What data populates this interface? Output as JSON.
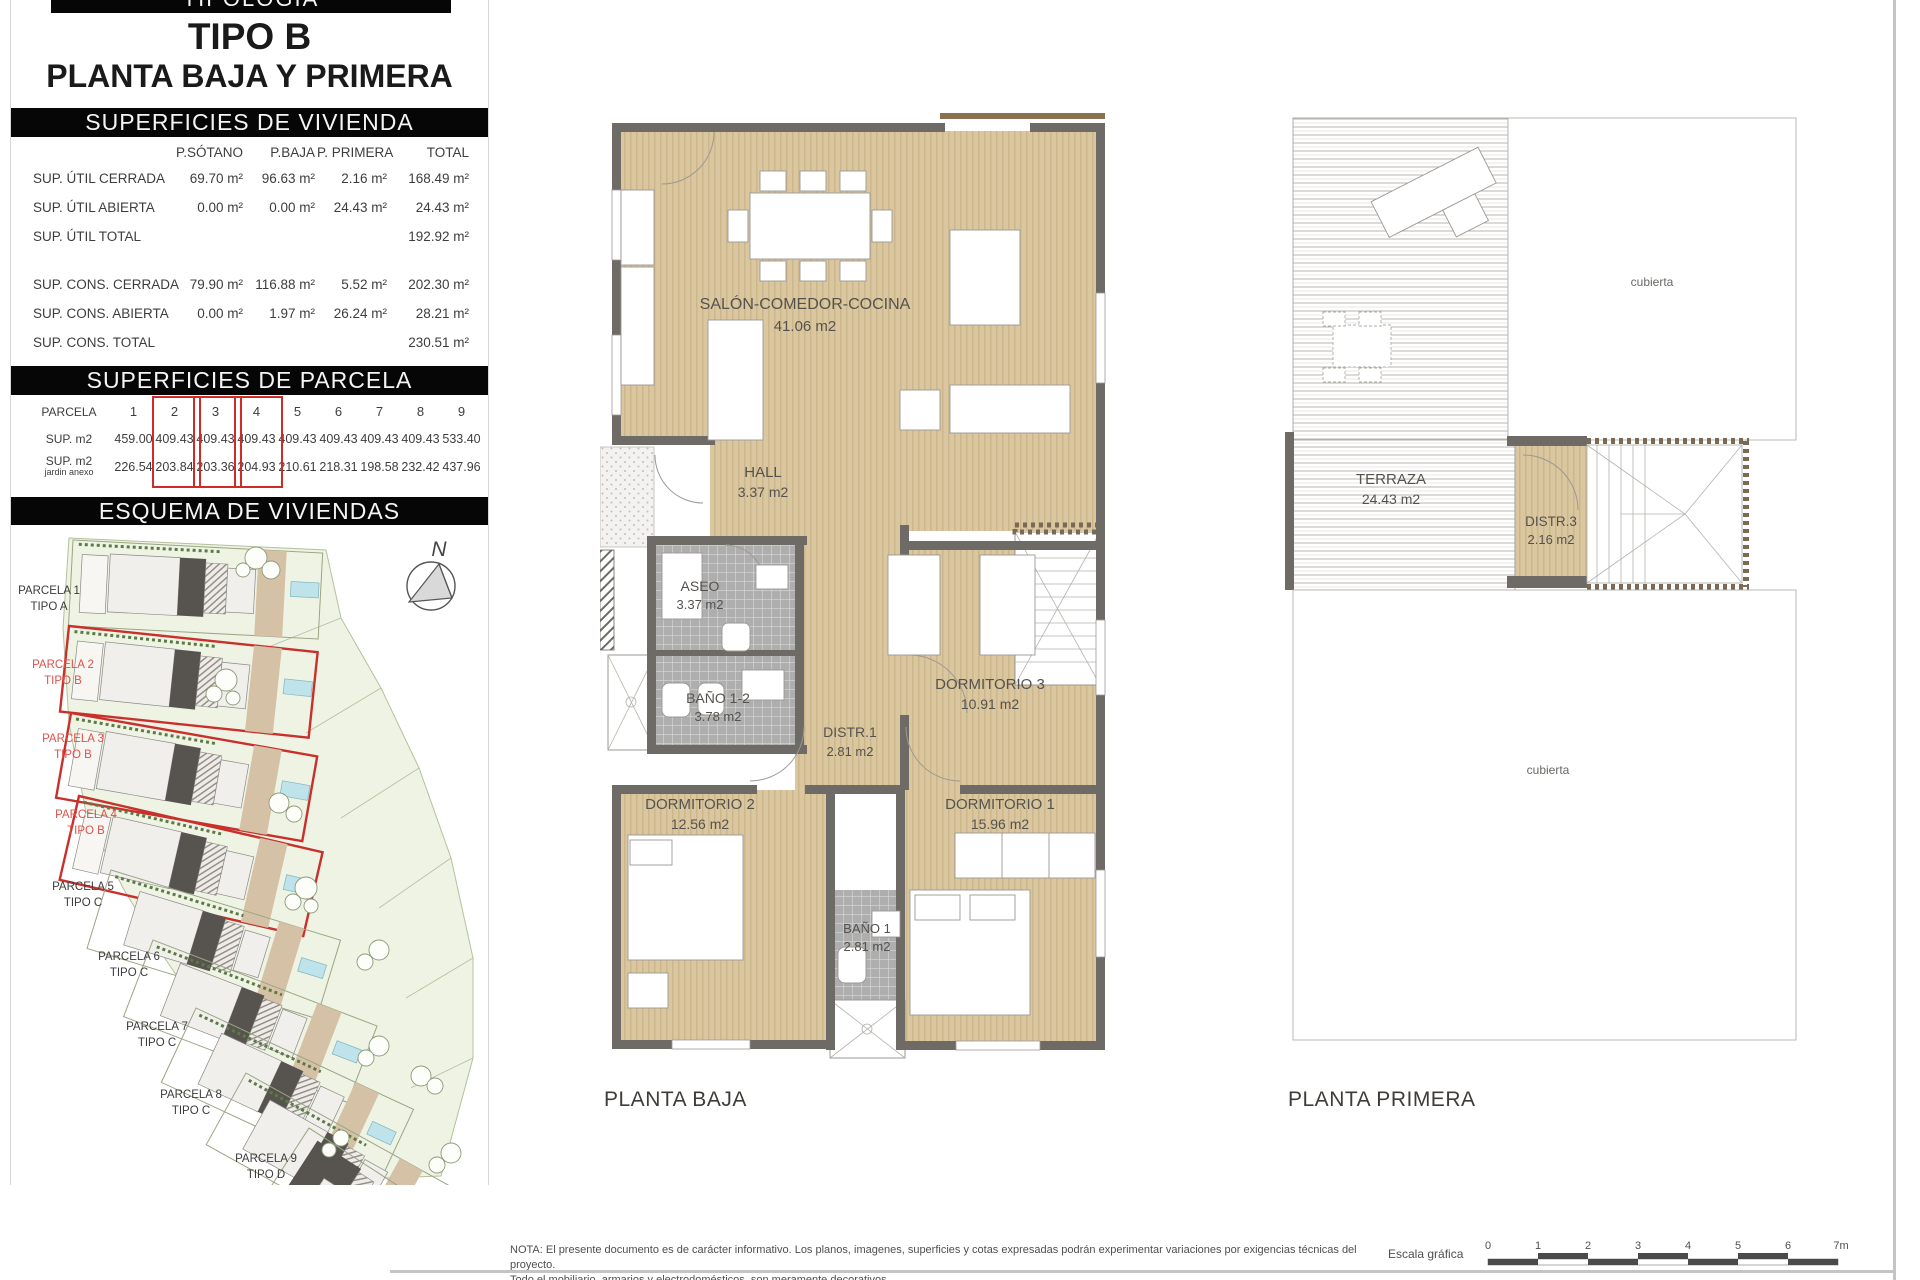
{
  "left_panel": {
    "top_bar": "TIPOLOGÍA",
    "title1": "TIPO B",
    "title2": "PLANTA BAJA Y PRIMERA",
    "vivienda": {
      "header": "SUPERFICIES DE VIVIENDA",
      "col_headers": [
        "P.SÓTANO",
        "P.BAJA",
        "P. PRIMERA",
        "TOTAL"
      ],
      "rows": [
        {
          "label": "SUP. ÚTIL CERRADA",
          "sotano": "69.70 m²",
          "baja": "96.63 m²",
          "primera": "2.16 m²",
          "total": "168.49 m²"
        },
        {
          "label": "SUP. ÚTIL ABIERTA",
          "sotano": "0.00 m²",
          "baja": "0.00 m²",
          "primera": "24.43 m²",
          "total": "24.43 m²"
        },
        {
          "label": "SUP. ÚTIL TOTAL",
          "sotano": "",
          "baja": "",
          "primera": "",
          "total": "192.92 m²"
        },
        {
          "label": "SUP. CONS. CERRADA",
          "sotano": "79.90 m²",
          "baja": "116.88 m²",
          "primera": "5.52 m²",
          "total": "202.30 m²"
        },
        {
          "label": "SUP. CONS. ABIERTA",
          "sotano": "0.00 m²",
          "baja": "1.97 m²",
          "primera": "26.24 m²",
          "total": "28.21 m²"
        },
        {
          "label": "SUP. CONS. TOTAL",
          "sotano": "",
          "baja": "",
          "primera": "",
          "total": "230.51 m²"
        }
      ]
    },
    "parcela": {
      "header": "SUPERFICIES DE PARCELA",
      "row1_label": "PARCELA",
      "row2_label": "SUP. m2",
      "row3_label_a": "SUP. m2",
      "row3_label_b": "jardin anexo",
      "numbers": [
        "1",
        "2",
        "3",
        "4",
        "5",
        "6",
        "7",
        "8",
        "9"
      ],
      "sup": [
        "459.00",
        "409.43",
        "409.43",
        "409.43",
        "409.43",
        "409.43",
        "409.43",
        "409.43",
        "533.40"
      ],
      "jardin": [
        "226.54",
        "203.84",
        "203.36",
        "204.93",
        "210.61",
        "218.31",
        "198.58",
        "232.42",
        "437.96"
      ]
    },
    "esquema": {
      "header": "ESQUEMA DE VIVIENDAS",
      "north": "N",
      "parcels": [
        {
          "name": "PARCELA 1",
          "tipo": "TIPO A",
          "color": "#3c3c3c"
        },
        {
          "name": "PARCELA 2",
          "tipo": "TIPO B",
          "color": "#e0514b"
        },
        {
          "name": "PARCELA 3",
          "tipo": "TIPO B",
          "color": "#e0514b"
        },
        {
          "name": "PARCELA 4",
          "tipo": "TIPO B",
          "color": "#e0514b"
        },
        {
          "name": "PARCELA 5",
          "tipo": "TIPO C",
          "color": "#3c3c3c"
        },
        {
          "name": "PARCELA 6",
          "tipo": "TIPO C",
          "color": "#3c3c3c"
        },
        {
          "name": "PARCELA 7",
          "tipo": "TIPO C",
          "color": "#3c3c3c"
        },
        {
          "name": "PARCELA 8",
          "tipo": "TIPO C",
          "color": "#3c3c3c"
        },
        {
          "name": "PARCELA 9",
          "tipo": "TIPO D",
          "color": "#3c3c3c"
        }
      ]
    }
  },
  "planta_baja": {
    "caption": "PLANTA BAJA",
    "rooms": {
      "salon": {
        "name": "SALÓN-COMEDOR-COCINA",
        "area": "41.06 m2"
      },
      "hall": {
        "name": "HALL",
        "area": "3.37 m2"
      },
      "aseo": {
        "name": "ASEO",
        "area": "3.37 m2"
      },
      "bano12": {
        "name": "BAÑO 1-2",
        "area": "3.78 m2"
      },
      "distr1": {
        "name": "DISTR.1",
        "area": "2.81 m2"
      },
      "dorm3": {
        "name": "DORMITORIO 3",
        "area": "10.91 m2"
      },
      "dorm2": {
        "name": "DORMITORIO 2",
        "area": "12.56 m2"
      },
      "dorm1": {
        "name": "DORMITORIO 1",
        "area": "15.96 m2"
      },
      "bano1": {
        "name": "BAÑO 1",
        "area": "2.81 m2"
      }
    }
  },
  "planta_primera": {
    "caption": "PLANTA PRIMERA",
    "rooms": {
      "cubierta_top": "cubierta",
      "terraza": {
        "name": "TERRAZA",
        "area": "24.43 m2"
      },
      "distr3": {
        "name": "DISTR.3",
        "area": "2.16 m2"
      },
      "cubierta_bottom": "cubierta"
    }
  },
  "footer": {
    "nota_line1": "NOTA: El presente documento es de carácter informativo. Los planos, imagenes, superficies y cotas expresadas podrán experimentar variaciones por exigencias técnicas del proyecto.",
    "nota_line2": "Todo el mobiliario, armarios y electrodomésticos, son meramente decorativos.",
    "escala_label": "Escala gráfica",
    "escala_ticks": [
      "0",
      "1",
      "2",
      "3",
      "4",
      "5",
      "6",
      "7m"
    ]
  },
  "colors": {
    "bar_bg": "#060606",
    "floor_beige": "#d9c69e",
    "wall_gray": "#6e6a66",
    "highlight_red": "#cf2b27",
    "site_green": "#eef3e3",
    "pool_blue": "#bfe3ea"
  }
}
